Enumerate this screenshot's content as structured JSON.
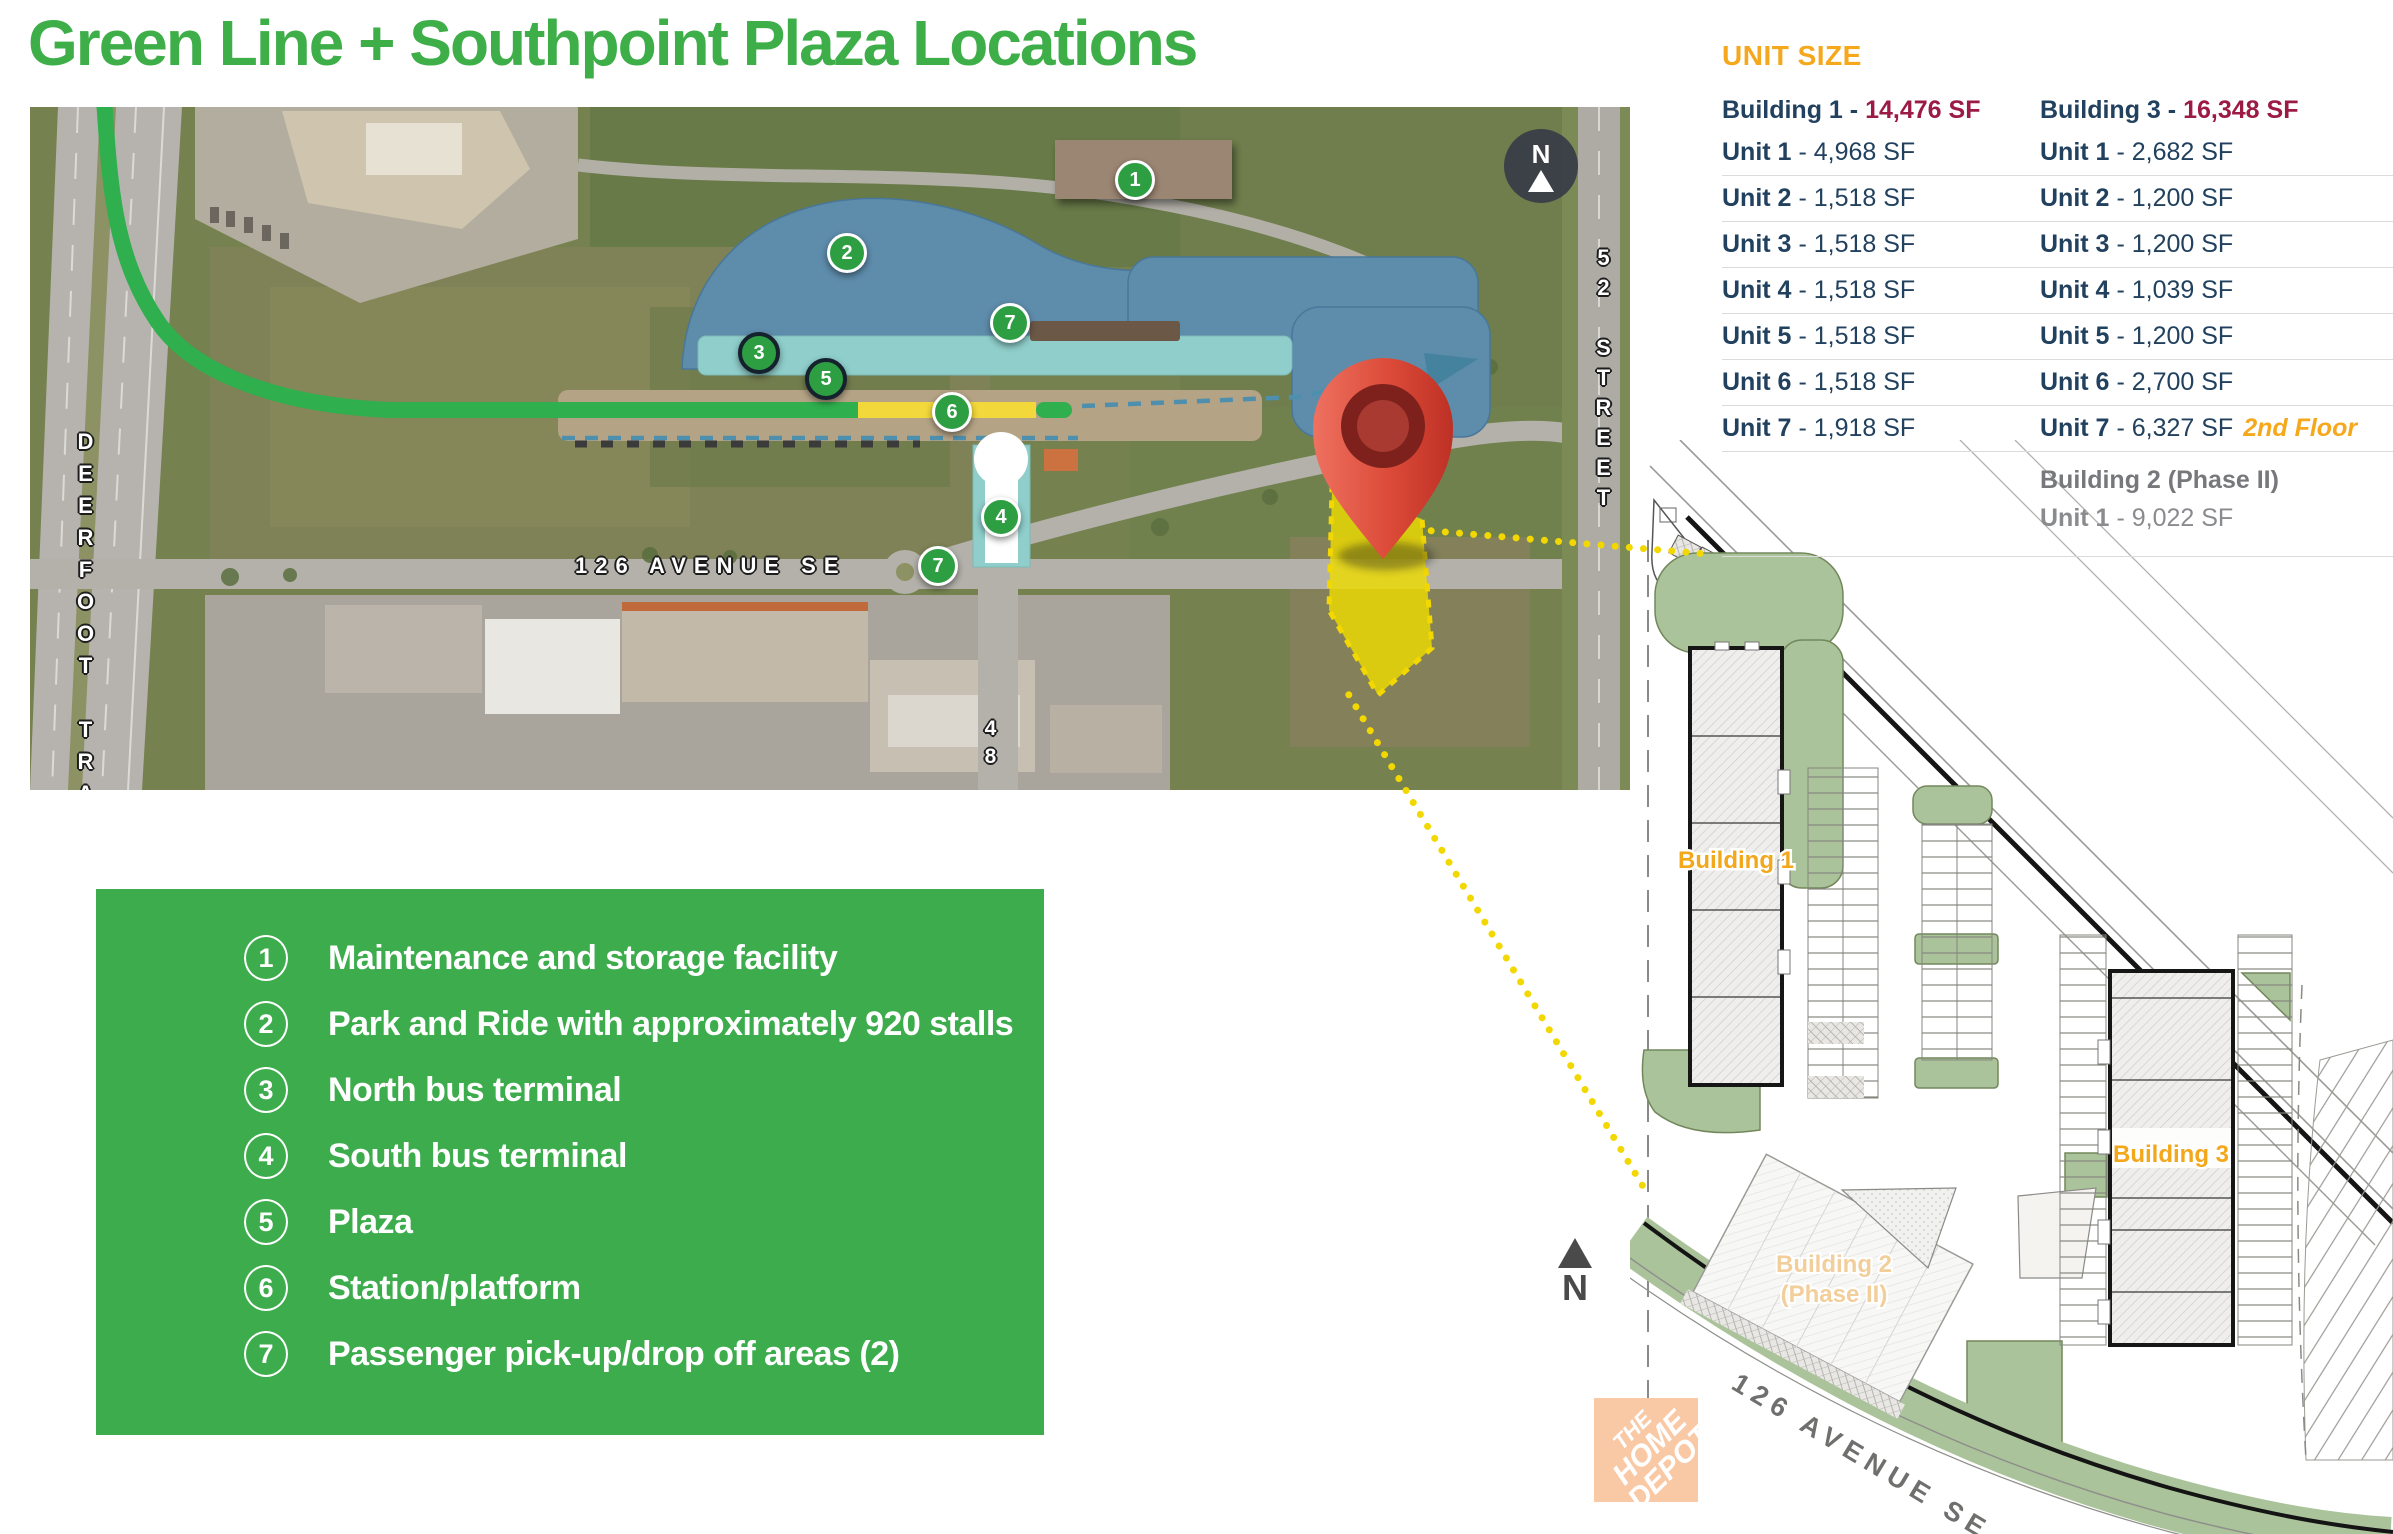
{
  "title": "Green Line + Southpoint Plaza Locations",
  "map": {
    "street_labels": {
      "deerfoot": "DEERFOOT TRAIL",
      "street_52": "52 STREET",
      "avenue_126": "126 AVENUE SE",
      "street_48": "48 ST"
    },
    "north_label": "N",
    "markers": {
      "m1": "1",
      "m2": "2",
      "m3": "3",
      "m4": "4",
      "m5": "5",
      "m6": "6",
      "m7a": "7",
      "m7b": "7"
    }
  },
  "legend": {
    "items": [
      {
        "num": "1",
        "label": "Maintenance and storage facility"
      },
      {
        "num": "2",
        "label": "Park and Ride with approximately 920 stalls"
      },
      {
        "num": "3",
        "label": "North bus terminal"
      },
      {
        "num": "4",
        "label": "South bus terminal"
      },
      {
        "num": "5",
        "label": "Plaza"
      },
      {
        "num": "6",
        "label": "Station/platform"
      },
      {
        "num": "7",
        "label": "Passenger pick-up/drop off areas (2)"
      }
    ]
  },
  "unit_table": {
    "heading": "UNIT SIZE",
    "building1": {
      "name": "Building 1 -",
      "total": "14,476 SF",
      "units": [
        {
          "name": "Unit 1",
          "size": "- 4,968 SF"
        },
        {
          "name": "Unit 2",
          "size": "- 1,518 SF"
        },
        {
          "name": "Unit 3",
          "size": "- 1,518 SF"
        },
        {
          "name": "Unit 4",
          "size": "- 1,518 SF"
        },
        {
          "name": "Unit 5",
          "size": "- 1,518 SF"
        },
        {
          "name": "Unit 6",
          "size": "- 1,518 SF"
        },
        {
          "name": "Unit 7",
          "size": "- 1,918 SF"
        }
      ]
    },
    "building3": {
      "name": "Building 3 -",
      "total": "16,348 SF",
      "units": [
        {
          "name": "Unit 1",
          "size": "- 2,682 SF"
        },
        {
          "name": "Unit 2",
          "size": "- 1,200 SF"
        },
        {
          "name": "Unit 3",
          "size": "- 1,200 SF"
        },
        {
          "name": "Unit 4",
          "size": "- 1,039 SF"
        },
        {
          "name": "Unit 5",
          "size": "- 1,200 SF"
        },
        {
          "name": "Unit 6",
          "size": "- 2,700 SF"
        },
        {
          "name": "Unit 7",
          "size": "- 6,327 SF",
          "note": "2nd Floor"
        }
      ]
    },
    "building2": {
      "name": "Building 2 (Phase II)",
      "unit_name": "Unit 1",
      "unit_size": "- 9,022 SF"
    }
  },
  "site_plan": {
    "building1_label": "Building 1",
    "building2_label_line1": "Building 2",
    "building2_label_line2": "(Phase II)",
    "building3_label": "Building 3",
    "avenue_label": "126 AVENUE SE",
    "north_label": "N",
    "home_depot": {
      "line1": "THE",
      "line2": "HOME",
      "line3": "DEPOT"
    }
  },
  "colors": {
    "brand_green": "#3EAE49",
    "legend_green": "#3CAC4C",
    "accent_orange": "#F5A81C",
    "navy": "#21415E",
    "crimson": "#9B1B45",
    "gray": "#77787B",
    "map_blue": "#5E8CAB",
    "map_teal": "#8FCECB",
    "map_tan": "#B5A386",
    "map_yellow": "#F2D83B",
    "line_green": "#2FAF4D",
    "marker_green": "#2E9E43",
    "pin_red": "#D6493B",
    "parcel_yellow": "#EDDC00",
    "plan_green": "#ABC39A"
  }
}
